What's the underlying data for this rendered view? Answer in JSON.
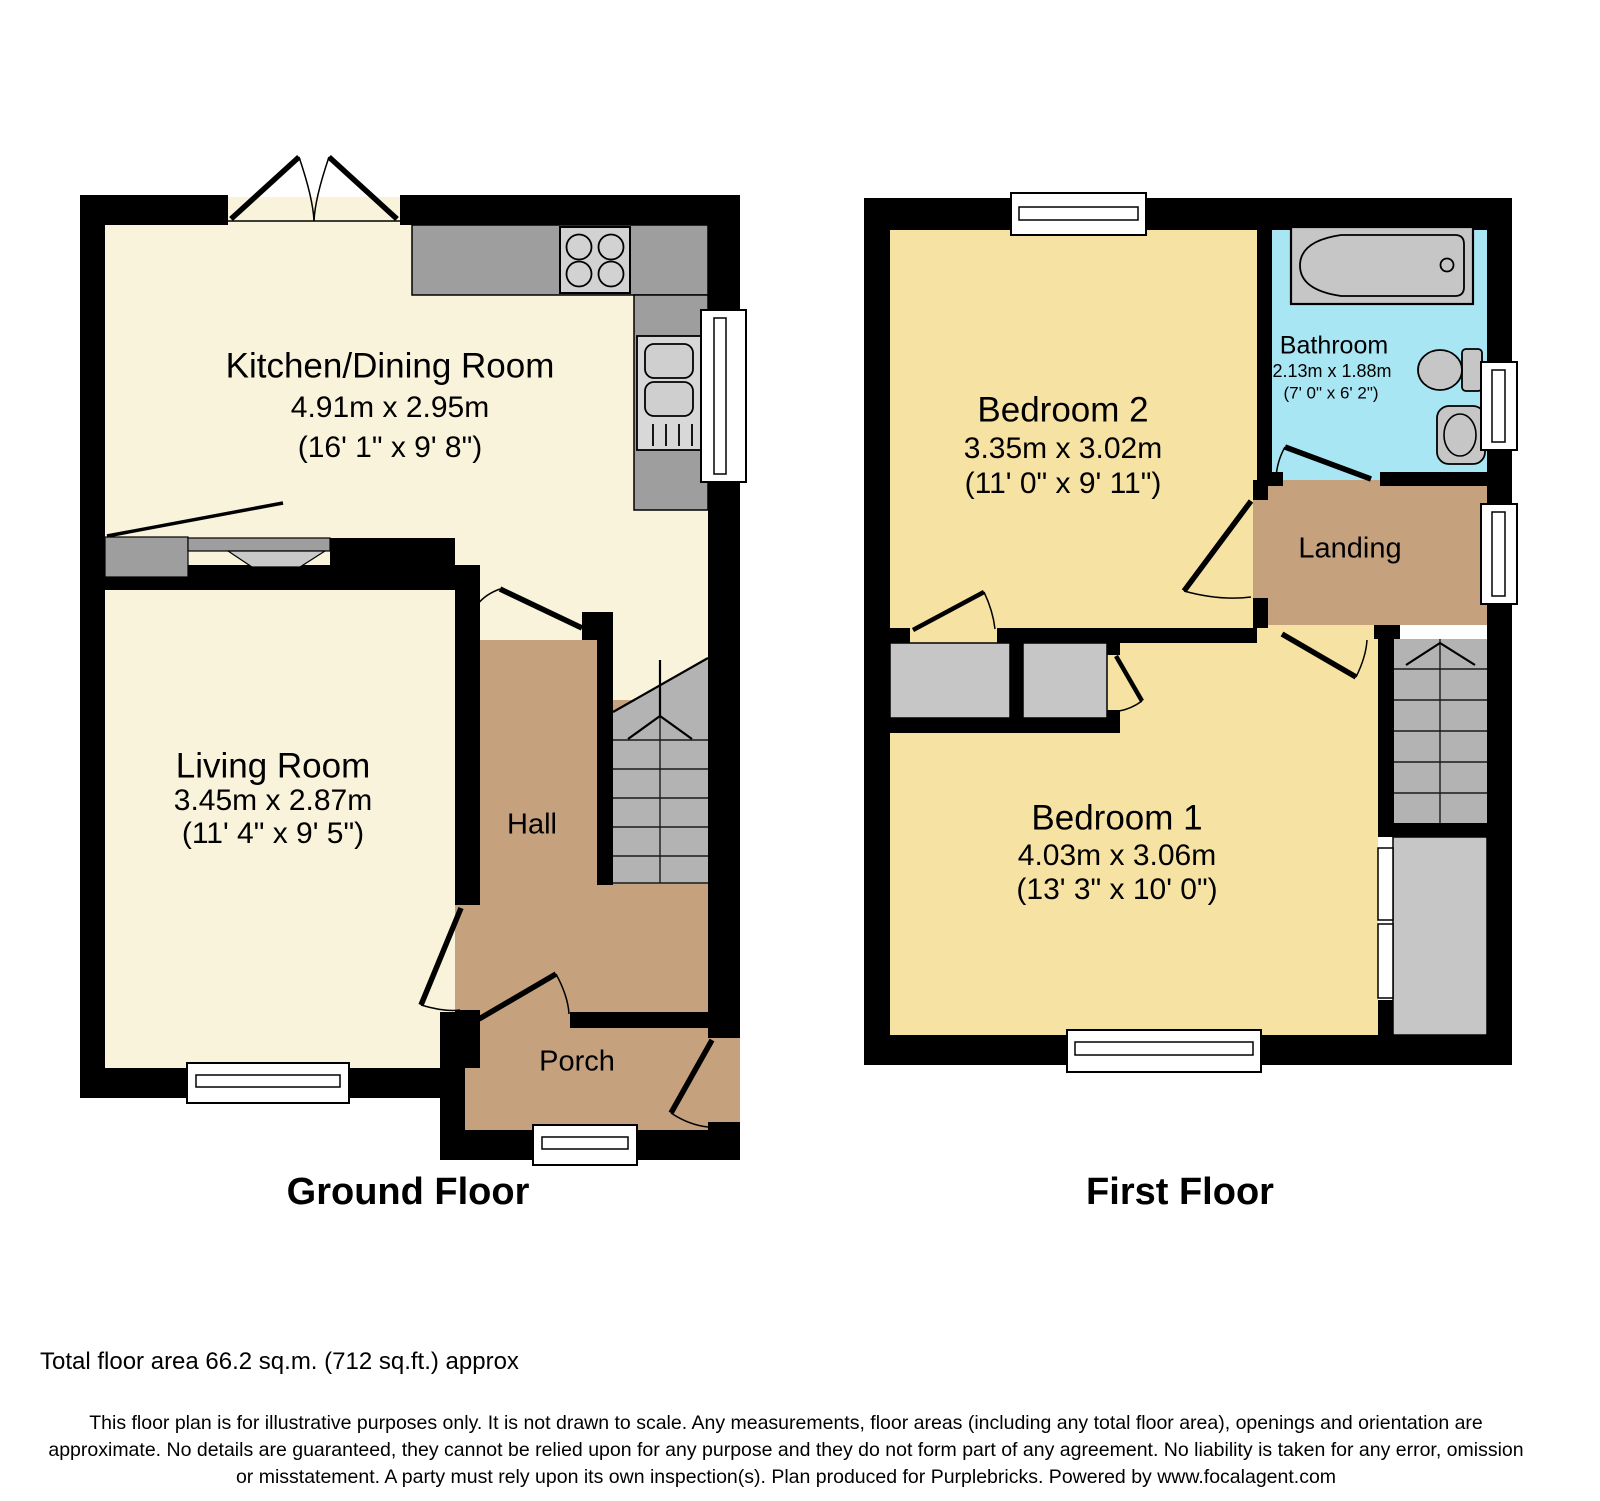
{
  "ground_floor": {
    "title": "Ground Floor",
    "kitchen": {
      "name": "Kitchen/Dining Room",
      "dims_m": "4.91m x 2.95m",
      "dims_ft": "(16' 1\" x 9' 8\")"
    },
    "living_room": {
      "name": "Living Room",
      "dims_m": "3.45m x 2.87m",
      "dims_ft": "(11' 4\" x 9' 5\")"
    },
    "hall": {
      "name": "Hall"
    },
    "porch": {
      "name": "Porch"
    }
  },
  "first_floor": {
    "title": "First Floor",
    "bedroom2": {
      "name": "Bedroom 2",
      "dims_m": "3.35m x 3.02m",
      "dims_ft": "(11' 0\" x 9' 11\")"
    },
    "bathroom": {
      "name": "Bathroom",
      "dims_m": "2.13m x 1.88m",
      "dims_ft": "(7' 0\" x 6' 2\")"
    },
    "landing": {
      "name": "Landing"
    },
    "bedroom1": {
      "name": "Bedroom 1",
      "dims_m": "4.03m x 3.06m",
      "dims_ft": "(13' 3\" x 10' 0\")"
    }
  },
  "footer": {
    "total_area": "Total floor area 66.2 sq.m. (712 sq.ft.) approx",
    "disclaimer_line1": "This floor plan is for illustrative purposes only. It is not drawn to scale. Any measurements, floor areas (including any total floor area), openings and orientation are",
    "disclaimer_line2": "approximate. No details are guaranteed, they cannot be relied upon for any purpose and they do not form part of any agreement. No liability is taken for any error, omission",
    "disclaimer_line3": "or misstatement. A party must rely upon its own inspection(s). Plan produced for Purplebricks. Powered by www.focalagent.com"
  },
  "colors": {
    "room_cream": "#f8f3da",
    "room_yellow": "#f6e2a2",
    "corridor_brown": "#c5a17e",
    "bathroom_blue": "#a9e6f4",
    "counter_gray": "#9e9e9e",
    "fixture_gray": "#c6c6c6",
    "stairs_gray": "#b3b3b3",
    "wall_black": "#000000"
  }
}
